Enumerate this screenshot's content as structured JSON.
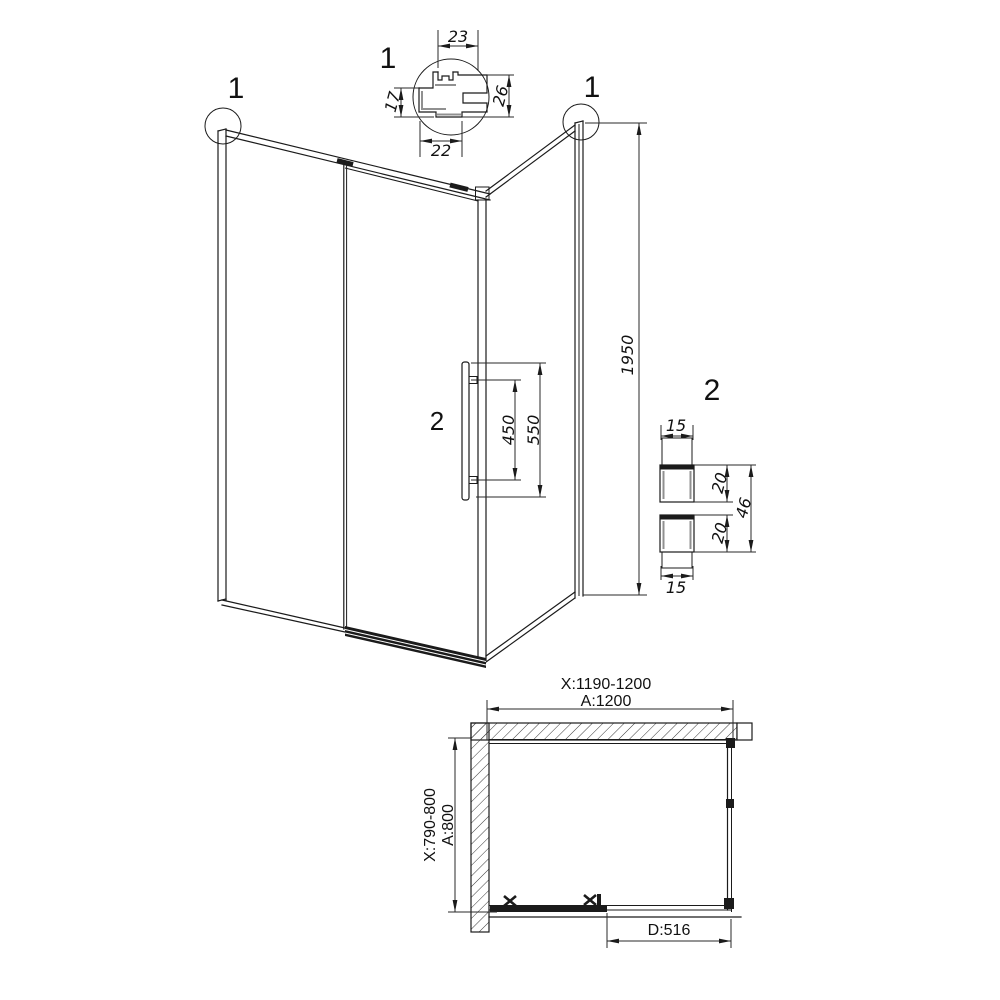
{
  "colors": {
    "line": "#1b1b1b",
    "shade": "#909090",
    "text": "#111111",
    "background": "#ffffff"
  },
  "view3d": {
    "callout_left_label": "1",
    "callout_right_label": "1",
    "handle_callout_label": "2",
    "height_mm": "1950",
    "handle_hole_spacing_mm": "450",
    "handle_length_mm": "550"
  },
  "detail1": {
    "label": "1",
    "top_width_mm": "23",
    "left_height_mm": "17",
    "right_height_mm": "26",
    "bottom_width_mm": "22"
  },
  "detail2": {
    "label": "2",
    "top_width_mm": "15",
    "upper_depth_mm": "20",
    "lower_depth_mm": "20",
    "overall_height_mm": "46",
    "bottom_width_mm": "15"
  },
  "plan": {
    "width_adjustment_range": "X:1190-1200",
    "width": "A:1200",
    "depth_adjustment_range": "X:790-800",
    "depth": "A:800",
    "door_opening": "D:516"
  }
}
